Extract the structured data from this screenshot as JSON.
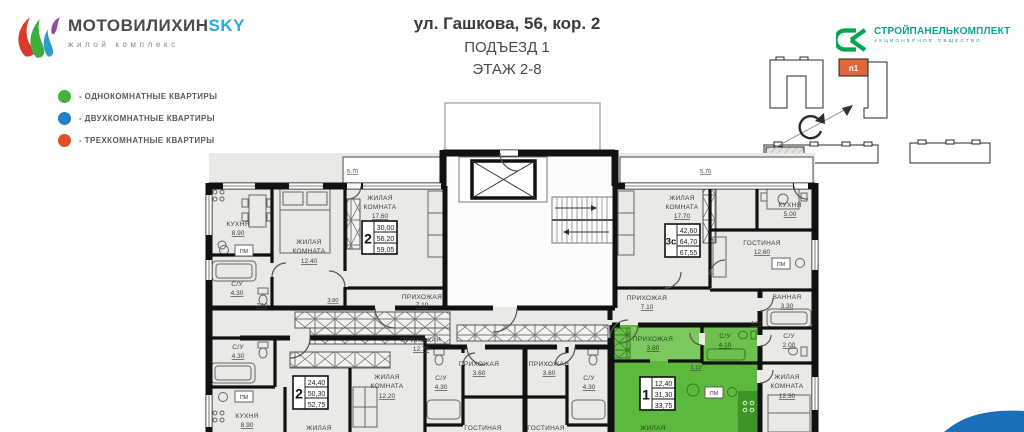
{
  "brand": {
    "name_main": "МОТОВИЛИХИН",
    "name_accent": "SKY",
    "subtitle": "жилой комплекс"
  },
  "legend": {
    "items": [
      {
        "label": "- ОДНОКОМНАТНЫЕ КВАРТИРЫ",
        "color": "#46b13a"
      },
      {
        "label": "- ДВУХКОМНАТНЫЕ КВАРТИРЫ",
        "color": "#2380c4"
      },
      {
        "label": "- ТРЕХКОМНАТНЫЕ КВАРТИРЫ",
        "color": "#e14f26"
      }
    ]
  },
  "title": {
    "address": "ул. Гашкова, 56, кор. 2",
    "entrance": "ПОДЪЕЗД 1",
    "floor": "ЭТАЖ 2-8"
  },
  "developer": {
    "name": "СТРОЙПАНЕЛЬКОМПЛЕКТ",
    "type": "АКЦИОНЕРНОЕ ОБЩЕСТВО"
  },
  "siteplan": {
    "highlight_label": "п1"
  },
  "colors": {
    "apartment_green": "#5db83e",
    "siteplan_orange": "#e0673c",
    "wave_blue": "#1a70b8",
    "brand_blue": "#29abe2",
    "developer_teal": "#12a190"
  },
  "plan": {
    "pm": "ПМ",
    "dims": {
      "bal_left": "5.70",
      "bal_right": "5.70",
      "w380": "3.80",
      "w210a": "2.10",
      "w210b": "2.10",
      "w470": "4.70"
    },
    "stamps": {
      "s2a": {
        "rooms": "2",
        "v1": "30,00",
        "v2": "56,20",
        "v3": "59,05"
      },
      "s3c": {
        "rooms": "3с",
        "v1": "42,60",
        "v2": "64,70",
        "v3": "67,55"
      },
      "s2b": {
        "rooms": "2",
        "v1": "24,40",
        "v2": "50,30",
        "v3": "52,75"
      },
      "s1": {
        "rooms": "1",
        "v1": "12,40",
        "v2": "31,30",
        "v3": "33,75"
      }
    },
    "rooms": {
      "kitchen_tl": {
        "n": "КУХНЯ",
        "a": "8.90"
      },
      "bed_1240": {
        "n1": "ЖИЛАЯ",
        "n2": "КОМНАТА",
        "a": "12.40"
      },
      "room_1760": {
        "n1": "ЖИЛАЯ",
        "n2": "КОМНАТА",
        "a": "17.60"
      },
      "su_430_tl": {
        "n": "С/У",
        "a": "4.30"
      },
      "hall_710_l": {
        "n": "ПРИХОЖАЯ",
        "a": "7.10"
      },
      "room_1770": {
        "n1": "ЖИЛАЯ",
        "n2": "КОМНАТА",
        "a": "17.70"
      },
      "kitchen_r": {
        "n": "КУХНЯ",
        "a": "5.00"
      },
      "living_1260": {
        "n": "ГОСТИНАЯ",
        "a": "12.60"
      },
      "hall_710_r": {
        "n": "ПРИХОЖАЯ",
        "a": "7.10"
      },
      "bath_330": {
        "n": "ВАННАЯ",
        "a": "3.30"
      },
      "su_200": {
        "n": "С/У",
        "a": "2.00"
      },
      "room_1230": {
        "n1": "ЖИЛАЯ",
        "n2": "КОМНАТА",
        "a": "12.30"
      },
      "hall_380": {
        "n": "ПРИХОЖАЯ",
        "a": "3.80"
      },
      "su_410": {
        "n": "С/У",
        "a": "4.10"
      },
      "hall_1270": {
        "n": "ПРИХОЖАЯ",
        "a": "12.70"
      },
      "hall_360_a": {
        "n": "ПРИХОЖАЯ",
        "a": "3.60"
      },
      "hall_360_b": {
        "n": "ПРИХОЖАЯ",
        "a": "3.60"
      },
      "su_430_ba": {
        "n": "С/У",
        "a": "4.30"
      },
      "su_430_bb": {
        "n": "С/У",
        "a": "4.30"
      },
      "living_a": {
        "n": "ГОСТИНАЯ"
      },
      "living_b": {
        "n": "ГОСТИНАЯ"
      },
      "su_430_bl": {
        "n": "С/У",
        "a": "4.30"
      },
      "kitchen_bl": {
        "n": "КУХНЯ",
        "a": "8.90"
      },
      "room_1220": {
        "n1": "ЖИЛАЯ",
        "n2": "КОМНАТА",
        "a": "12.20"
      },
      "room_cut_l": {
        "n": "ЖИЛАЯ"
      },
      "room_cut_g": {
        "n": "ЖИЛАЯ"
      }
    }
  }
}
